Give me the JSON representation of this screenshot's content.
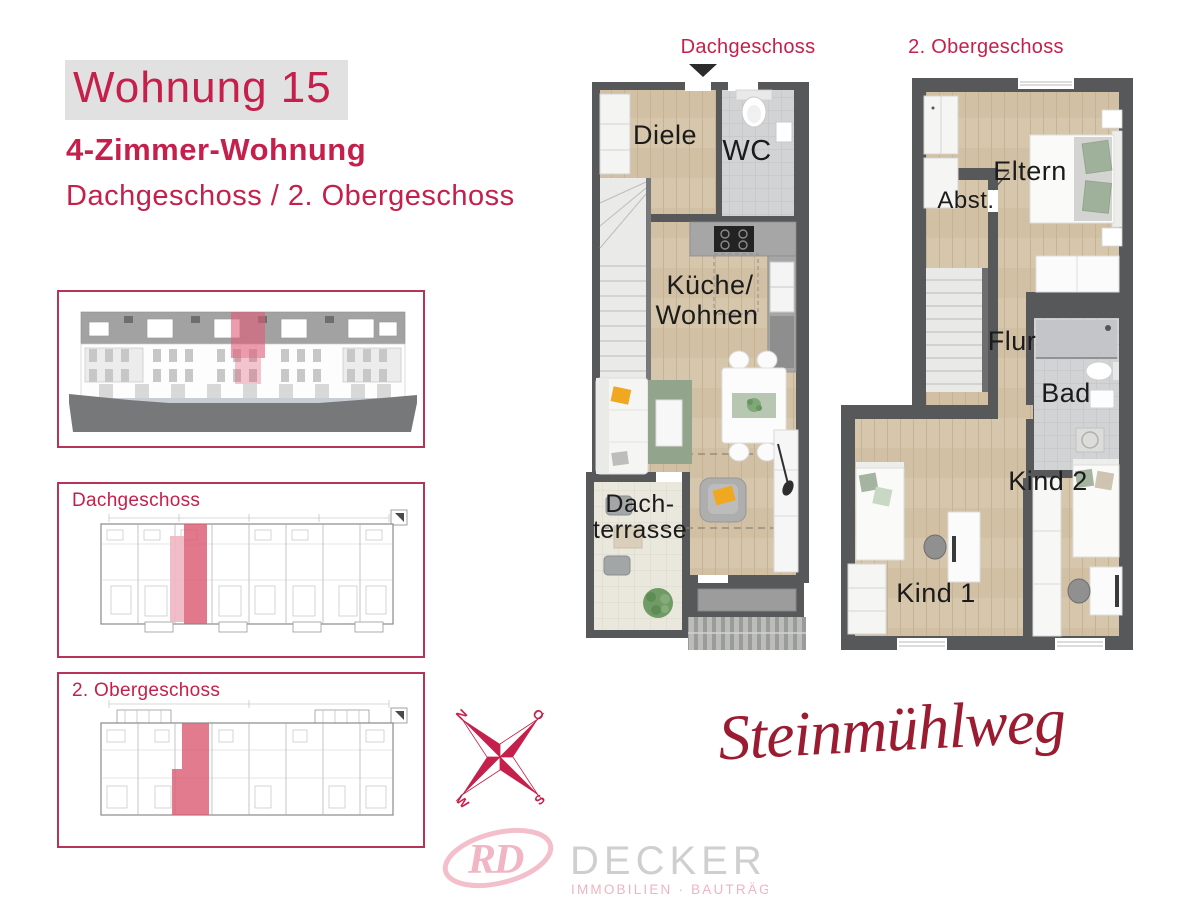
{
  "header": {
    "title": "Wohnung 15",
    "subtitle": "4-Zimmer-Wohnung",
    "floors": "Dachgeschoss / 2. Obergeschoss"
  },
  "sidebar": {
    "dg_label": "Dachgeschoss",
    "og_label": "2. Obergeschoss"
  },
  "plans": {
    "dg": {
      "title": "Dachgeschoss",
      "rooms": {
        "diele": "Diele",
        "wc": "WC",
        "kueche1": "Küche/",
        "kueche2": "Wohnen",
        "terrasse1": "Dach-",
        "terrasse2": "terrasse"
      }
    },
    "og": {
      "title": "2. Obergeschoss",
      "rooms": {
        "eltern": "Eltern",
        "abst": "Abst.",
        "flur": "Flur",
        "bad": "Bad",
        "kind2": "Kind 2",
        "kind1": "Kind 1"
      }
    }
  },
  "compass": {
    "n": "N",
    "o": "O",
    "s": "S",
    "w": "W"
  },
  "street_name": "Steinmühlweg",
  "logo": {
    "monogram": "RD",
    "name": "DECKER",
    "tagline": "IMMOBILIEN · BAUTRÄGER"
  },
  "colors": {
    "accent_red": "#c5204b",
    "script_red": "#9b1b31",
    "box_border": "#b53457",
    "highlight_pink": "#dc5a73",
    "wall_gray": "#57585a",
    "wood_floor": "#d6c6ab",
    "tile_gray": "#d2d3d5",
    "terrace_tile": "#eae7dd",
    "logo_pink": "#efb0bf",
    "logo_gray": "#cccccc"
  }
}
